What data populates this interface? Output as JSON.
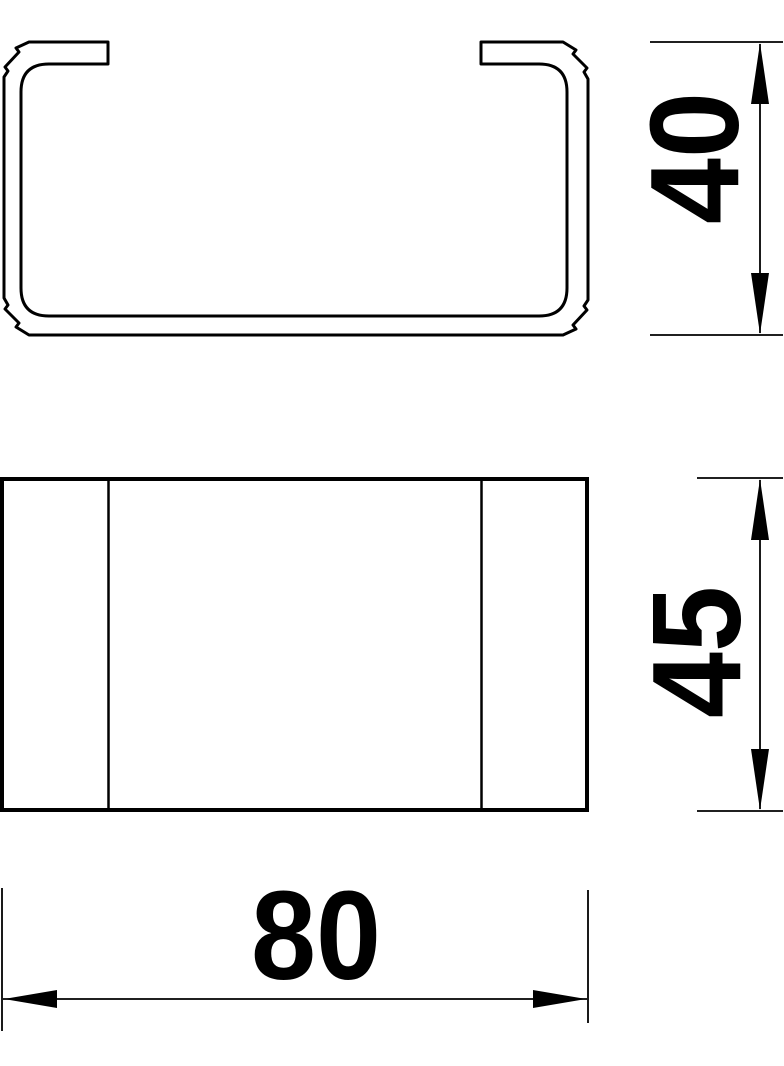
{
  "colors": {
    "line": "#000000",
    "background": "#ffffff"
  },
  "dimensions": {
    "height": "40",
    "depth": "45",
    "width": "80"
  }
}
